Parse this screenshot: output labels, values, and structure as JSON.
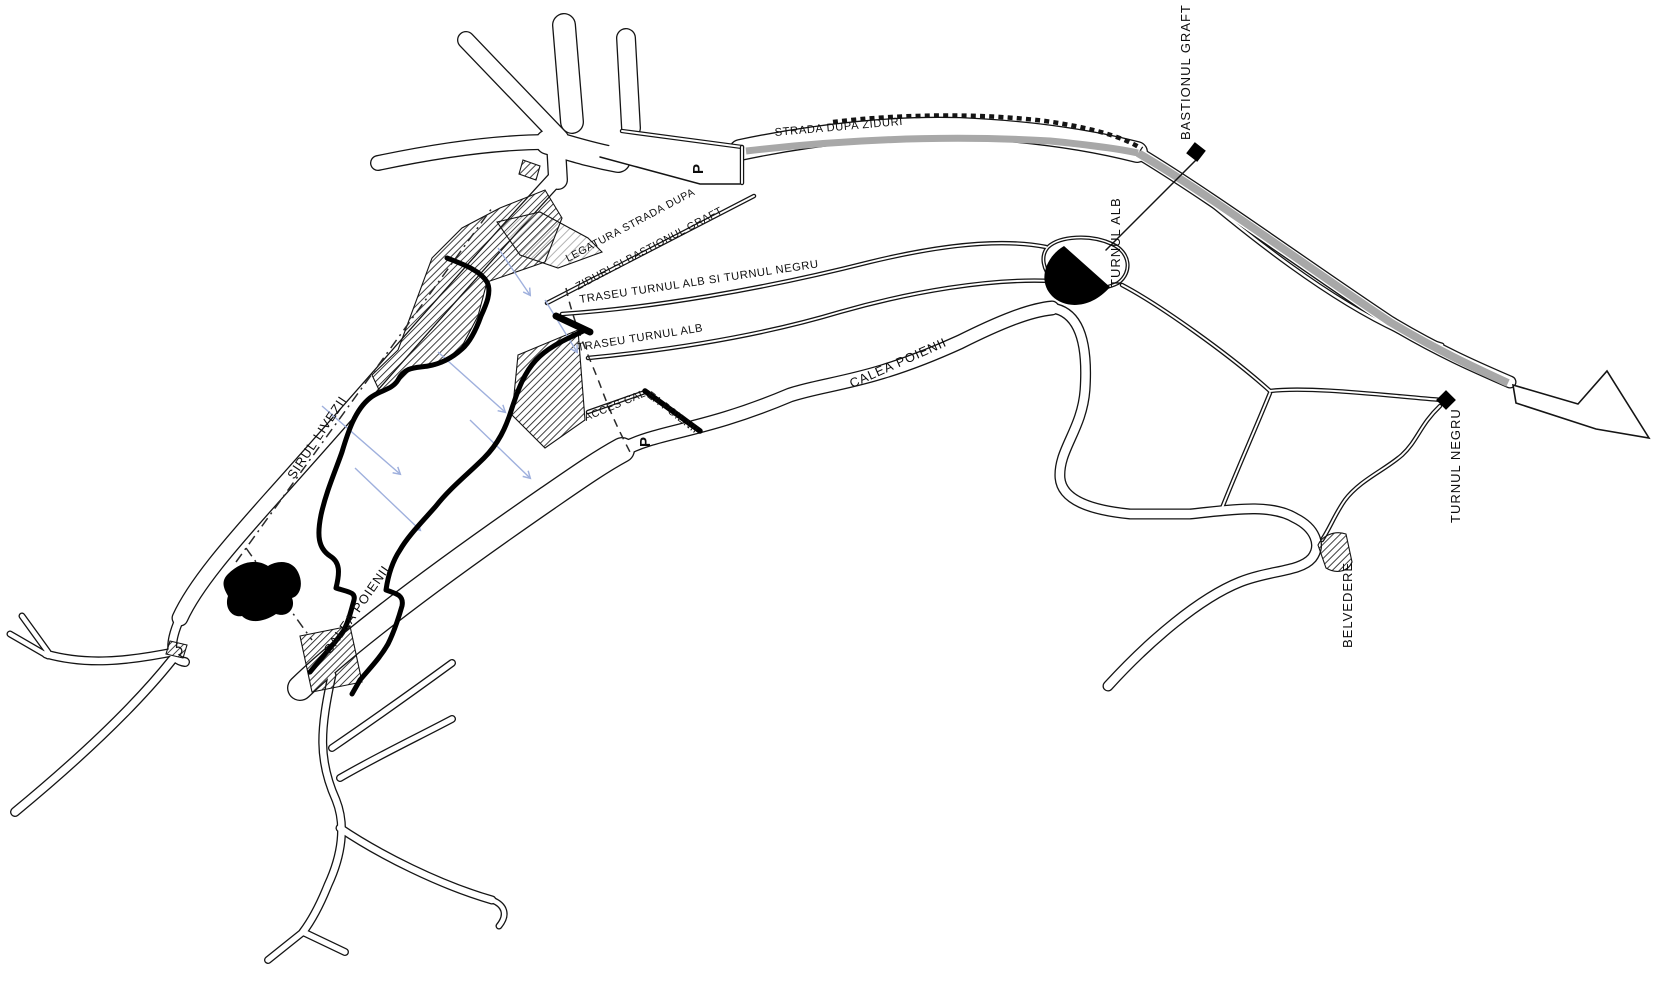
{
  "map": {
    "title": "Site plan - Dupa Ziduri promenade",
    "streets": {
      "strada_dupa_ziduri": "STRADA DUPA ZIDURI",
      "sirul_livezii": "SIRUL LIVEZII",
      "calea_poienii_upper": "CALEA POIENII",
      "calea_poienii_lower": "CALEA POIENII"
    },
    "routes": {
      "legatura_line1": "LEGATURA STRADA DUPA",
      "legatura_line2": "ZIDURI SI BASTIONUL GRAFT",
      "traseu_alb_negru": "TRASEU TURNUL ALB SI TURNUL NEGRU",
      "traseu_alb": "TRASEU TURNUL ALB",
      "acces_calea_poienii": "ACCES CALEA POIENII"
    },
    "landmarks": {
      "bastionul_graft": {
        "label": "BASTIONUL GRAFT",
        "marker": "black-square"
      },
      "turnul_alb": {
        "label": "TURNUL ALB",
        "marker": "black-semicircle-tower"
      },
      "turnul_negru": {
        "label": "TURNUL NEGRU",
        "marker": "black-diamond"
      },
      "belvedere": {
        "label": "BELVEDERE",
        "marker": "hatched-wedge"
      }
    },
    "parking": {
      "p1": "P",
      "p2": "P"
    },
    "colors": {
      "line": "#141414",
      "wall_band": "#a8a8a8",
      "slope_arrow": "#9fb0dd",
      "background": "#ffffff"
    }
  }
}
